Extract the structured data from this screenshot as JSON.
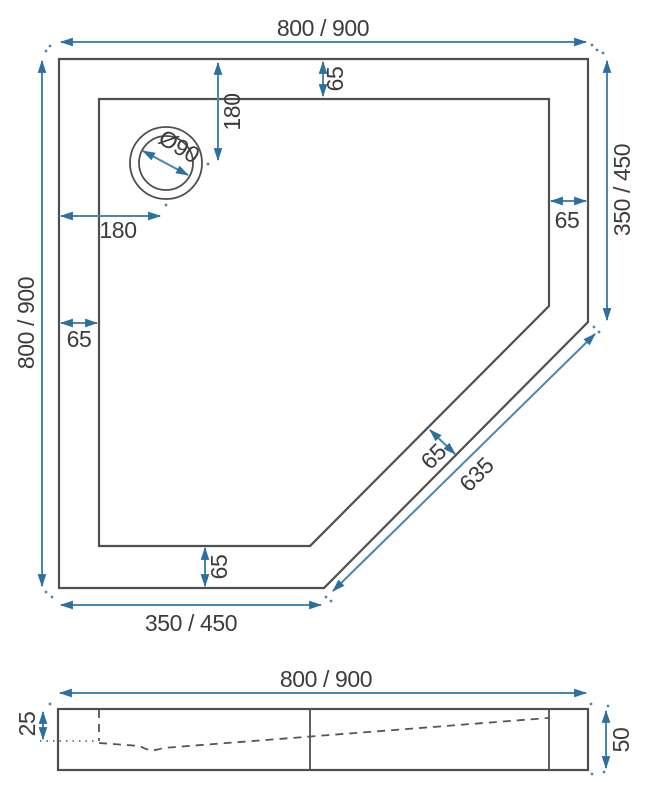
{
  "drawing_title": "pentagon-shower-tray-technical-drawing",
  "colors": {
    "dimension_accent": "#4a86ad",
    "arrowhead": "#2d6f9e",
    "outline": "#4f4f4f",
    "label_text": "#3c3c3c",
    "background": "#ffffff"
  },
  "top_view": {
    "overall_width": "800 / 900",
    "overall_height": "800 / 900",
    "right_edge": "350 / 450",
    "bottom_edge": "350 / 450",
    "diagonal_edge": "635",
    "rim_top": "65",
    "rim_right": "65",
    "rim_left": "65",
    "rim_bottom": "65",
    "rim_diagonal": "65",
    "drain_offset_top": "180",
    "drain_offset_left": "180",
    "drain_diameter": "Ø90"
  },
  "side_view": {
    "overall_width": "800 / 900",
    "basin_depth": "25",
    "total_height": "50"
  }
}
